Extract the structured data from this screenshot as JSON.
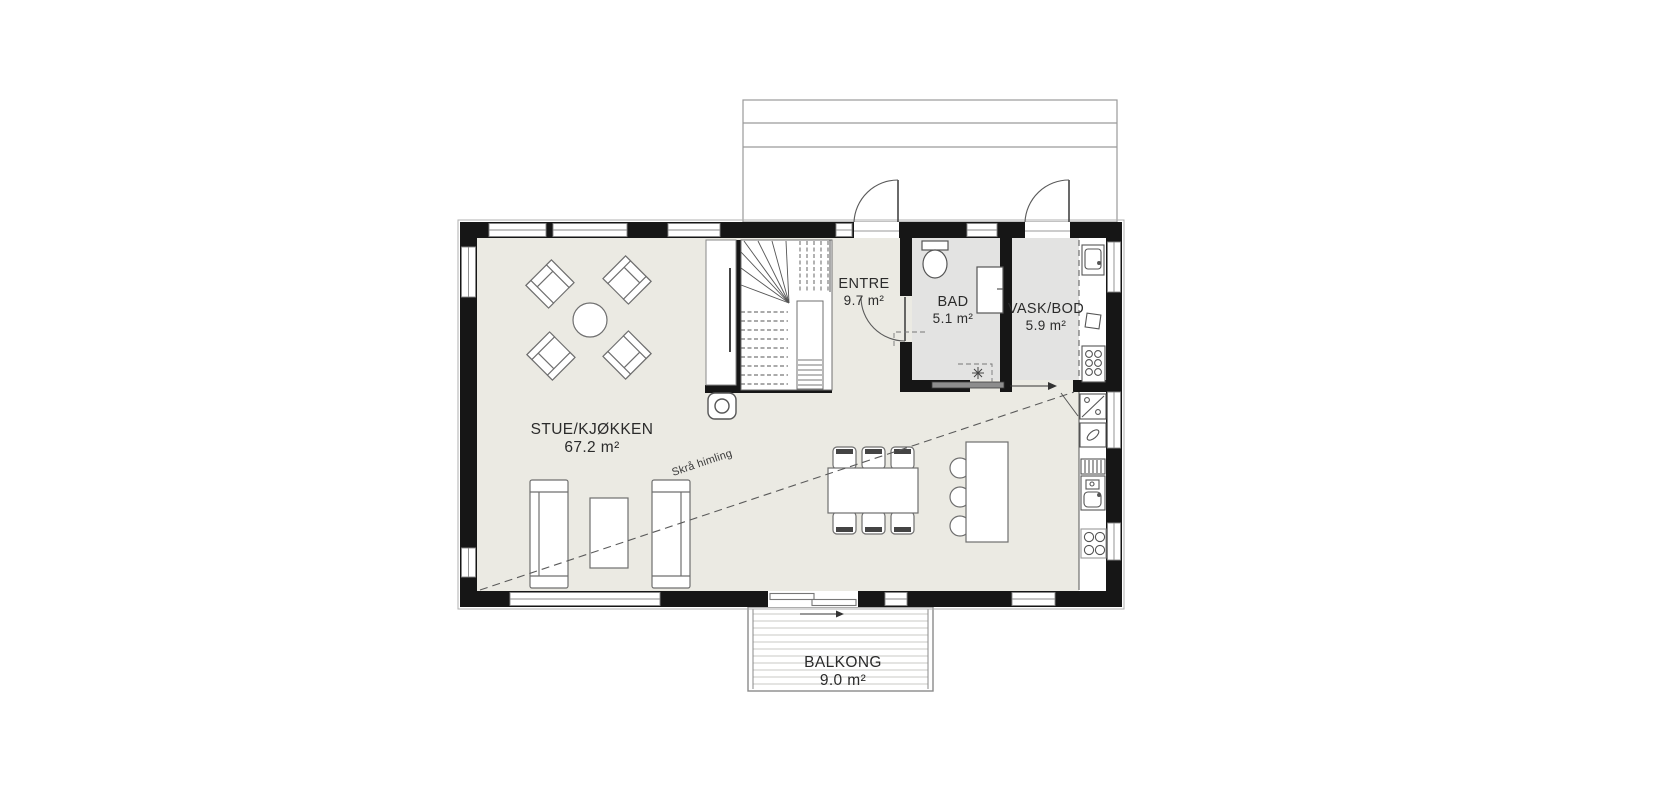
{
  "page": {
    "background": "#ffffff",
    "type": "architectural floor plan"
  },
  "floorplan": {
    "rooms": [
      {
        "id": "stue",
        "name": "STUE/KJØKKEN",
        "area": "67.2 m²"
      },
      {
        "id": "entre",
        "name": "ENTRE",
        "area": "9.7 m²"
      },
      {
        "id": "bad",
        "name": "BAD",
        "area": "5.1 m²"
      },
      {
        "id": "vaskbod",
        "name": "VASK/BOD",
        "area": "5.9 m²"
      },
      {
        "id": "balkong",
        "name": "BALKONG",
        "area": "9.0 m²"
      }
    ],
    "annotations": [
      {
        "id": "skraa",
        "text": "Skrå himling"
      }
    ],
    "colors": {
      "wall": "#161616",
      "floor_main": "#ebeae3",
      "floor_wet": "#e3e3e2",
      "outline": "#8a8a8a",
      "furniture_line": "#6f6f6f",
      "deck_line": "#9a9a9a"
    },
    "icons": [
      "staircase-icon",
      "wood-stove-icon",
      "toilet-icon",
      "shower-cabinet-icon",
      "floor-drain-icon",
      "washing-machine-icon",
      "utility-sink-icon",
      "kitchen-sink-icon",
      "cooktop-icon",
      "vent-hood-icon",
      "sliding-door-arrow-icon",
      "door-swing-icon",
      "window-icon",
      "dining-table-icon",
      "dining-chair-icon",
      "armchair-icon",
      "sofa-icon",
      "coffee-table-icon",
      "kitchen-island-icon",
      "bar-stool-icon"
    ]
  }
}
